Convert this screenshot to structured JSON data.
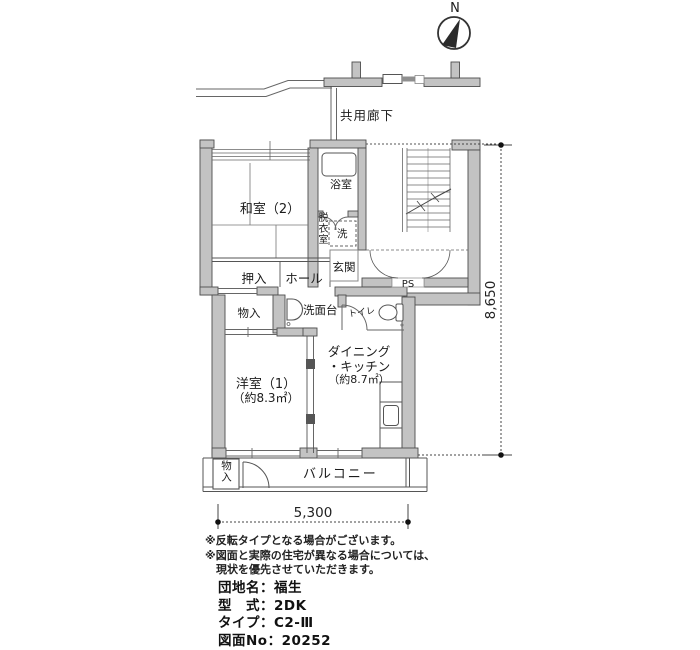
{
  "compass": {
    "north_label": "N"
  },
  "plan": {
    "corridor_label": "共用廊下",
    "washitsu2_label": "和室（2）",
    "bath_label": "浴室",
    "dressing_label": "脱衣室",
    "washer_label": "洗",
    "entrance_label": "玄関",
    "oshiire_label": "押入",
    "hall_label": "ホール",
    "ps_label": "PS",
    "storage1_label": "物入",
    "vanity_label": "洗面台",
    "toilet_label": "トイレ",
    "dk_label_line1": "ダイニング",
    "dk_label_line2": "・キッチン",
    "dk_area": "（約8.7㎡）",
    "yoshitsu1_label": "洋室（1）",
    "yoshitsu1_area": "（約8.3㎡）",
    "balcony_label": "バルコニー",
    "storage2_label": "物入"
  },
  "dimensions": {
    "vertical": "8,650",
    "horizontal": "5,300"
  },
  "notes": [
    "※反転タイプとなる場合がございます。",
    "※図面と実際の住宅が異なる場合については、",
    "現状を優先させていただきます。"
  ],
  "info": {
    "line1": "団地名：福生",
    "line2": "型　式：2DK",
    "line3": "タイプ：C2-Ⅲ",
    "line4": "図面No：20252"
  },
  "colors": {
    "wall_fill": "#c3c3c3",
    "line": "#4d4d4d",
    "text": "#1c1c1c"
  }
}
